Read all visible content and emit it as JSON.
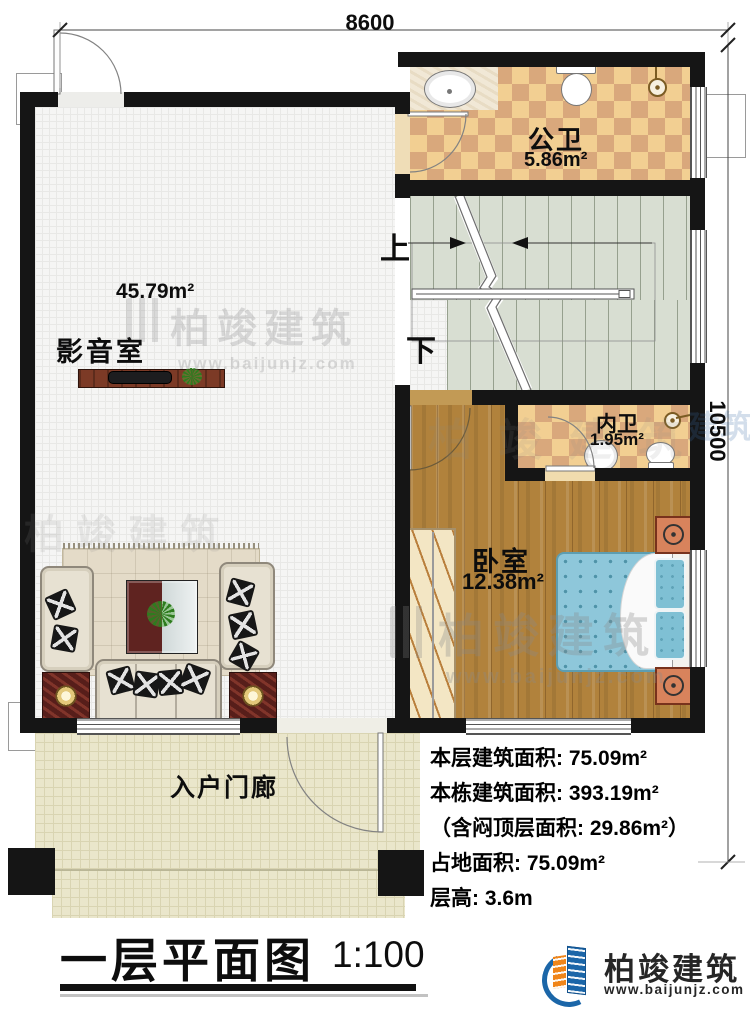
{
  "plan": {
    "dim_top": "8600",
    "dim_right": "10500",
    "rooms": {
      "public_bath": {
        "name": "公卫",
        "area": "5.86m²"
      },
      "media_room": {
        "name": "影音室",
        "area": "45.79m²"
      },
      "private_bath": {
        "name": "内卫",
        "area": "1.95m²"
      },
      "bedroom": {
        "name": "卧室",
        "area": "12.38m²"
      },
      "porch": {
        "name": "入户门廊"
      },
      "stairs": {
        "up": "上",
        "down": "下"
      }
    }
  },
  "stats": {
    "lines": [
      "本层建筑面积: 75.09m²",
      "本栋建筑面积: 393.19m²",
      "（含闷顶层面积: 29.86m²）",
      "占地面积: 75.09m²",
      "层高: 3.6m"
    ]
  },
  "title": {
    "text": "一层平面图",
    "scale": "1:100"
  },
  "brand": {
    "name": "柏竣建筑",
    "website": "www.baijunjz.com"
  },
  "watermark": {
    "text": "柏竣建筑",
    "url": "www.baijunjz.com",
    "fragment": "建筑"
  },
  "colors": {
    "wall": "#151515",
    "tile_light": "#f2cf92",
    "tile_dark": "#d9a87c",
    "wood": "#b1823c",
    "stairs": "#d8ded2",
    "porch": "#eae6cb",
    "bed": "#8ec7da",
    "brand_blue": "#1b66a8",
    "brand_orange": "#f08519"
  }
}
